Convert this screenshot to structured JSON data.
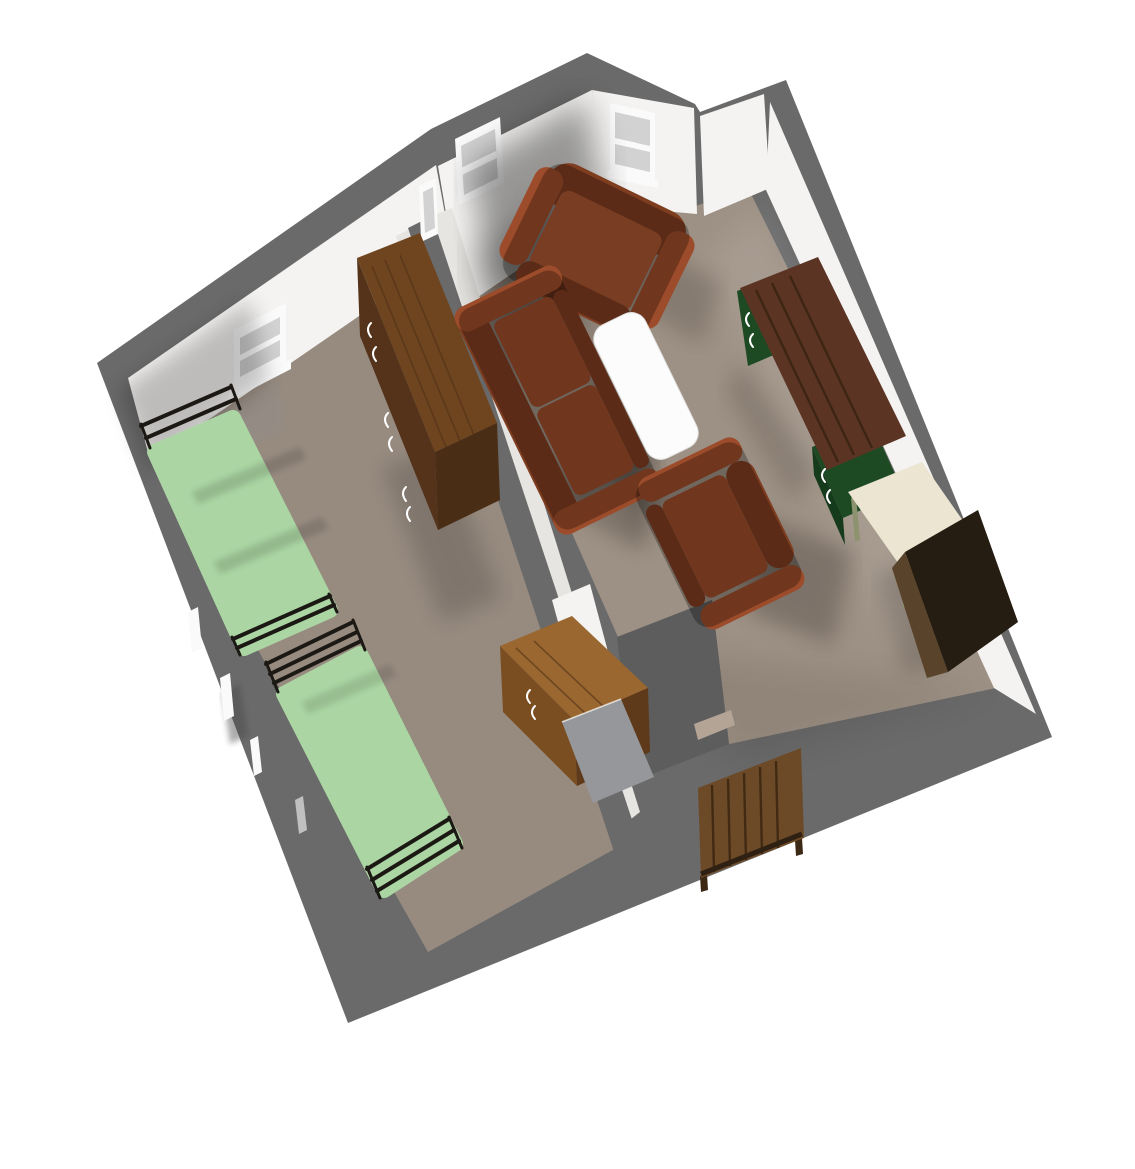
{
  "scene": {
    "render_type": "3d-dollhouse-floor-plan-render",
    "view": "overhead isometric, rotated ~45 degrees",
    "rooms": [
      {
        "id": "bedroom",
        "furniture": [
          "single-bed-upper",
          "single-bed-lower",
          "tall-wardrobe",
          "wooden-desk",
          "open-door-panel"
        ],
        "windows": 2
      },
      {
        "id": "living-room",
        "furniture": [
          "armchair-top",
          "two-seat-sofa",
          "armchair-center",
          "white-coffee-table",
          "pedestal-desk",
          "cream-side-table",
          "dark-corner-armchair"
        ],
        "windows": 3
      }
    ],
    "exterior_objects": [
      "wooden-dresser-outside-south-wall"
    ]
  },
  "colors": {
    "background": "#ffffff",
    "wall_exterior": "#6a6a6a",
    "step_gray": "#5d5d5d",
    "wall_interior": "#f4f3f1",
    "wall_interior_dim": "#e7e5e2",
    "floor_bedroom": "#b5a79a",
    "floor_living": "#bcad9f",
    "doorway_floor": "#b3a496",
    "bed_green": "#abd5a3",
    "bed_frame": "#1c1914",
    "wardrobe_top": "#6f4520",
    "wardrobe_front": "#54331a",
    "wardrobe_side": "#4a2d15",
    "desk_wood_top": "#9a6730",
    "desk_wood_front": "#7b4e22",
    "desk_wood_side": "#5f3a1a",
    "sofa": "#9c4c2a",
    "sofa_dark": "#7f3d20",
    "sofa_light": "#a85530",
    "table_white": "#fcfcfc",
    "desk_top_brown": "#5c3424",
    "pedestal_green": "#1d4a23",
    "pedestal_green_dark": "#163a1c",
    "side_table_cream": "#ebe5d2",
    "side_table_leg": "#8d926f",
    "corner_chair": "#382a1a",
    "corner_chair_light": "#59442b",
    "dresser_wood": "#6d4a27",
    "dresser_wood_dark": "#3c2915",
    "door_gray": "#95979a",
    "window_pane": "#d2d2d2",
    "window_frame": "#fafafa",
    "handle": "#ffffff"
  }
}
